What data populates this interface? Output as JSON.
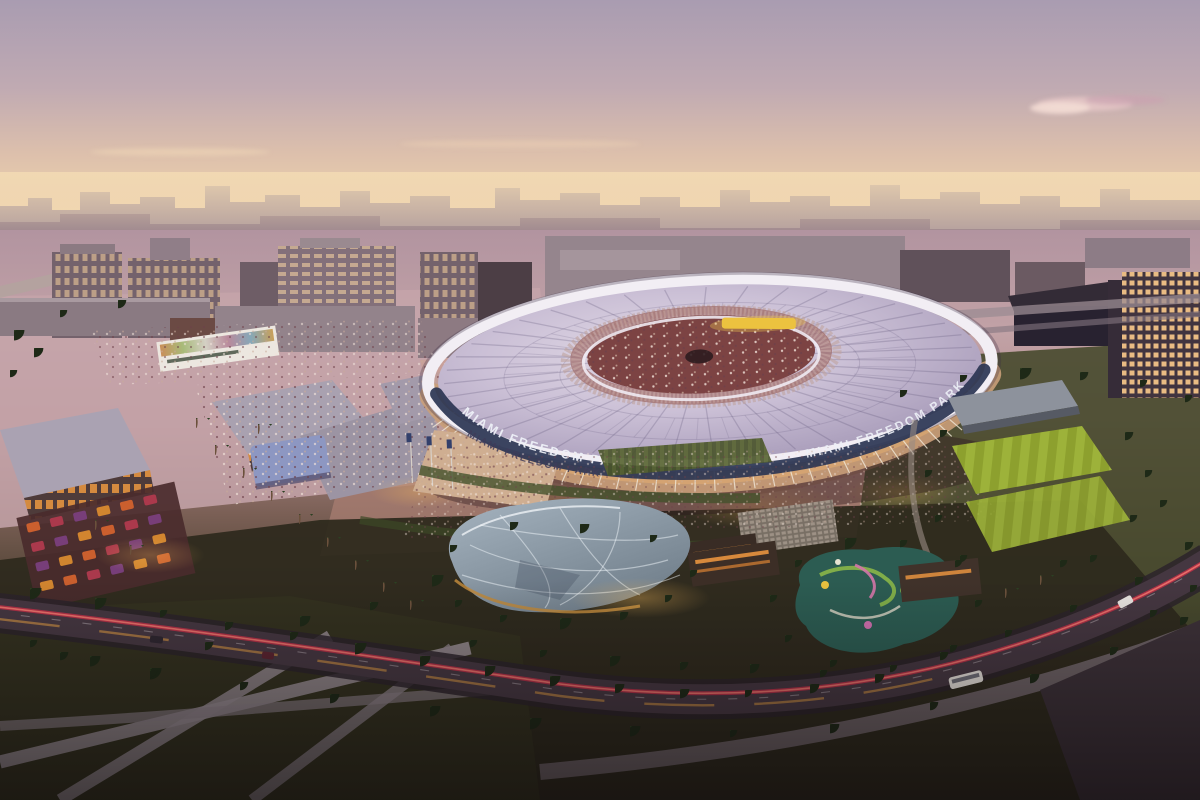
{
  "scene": {
    "stadium": {
      "rim_signage_left": "MIAMI FREEDOM PARK",
      "rim_signage_right": "MIAMI FREEDOM PARK",
      "facade_signage": "MIAMI FREEDOM PARK"
    },
    "palette": {
      "sky_top": "#a99cb1",
      "sky_mid": "#c0aab2",
      "sky_horizon": "#f3dcb6",
      "skyline_haze": "#9f8c96",
      "stadium_roof": "#cbc0d6",
      "stadium_ring": "#f2eef4",
      "signage_band": "#2b3552",
      "signage_text": "#eef1f8",
      "scoreboard_yellow": "#ecc23f",
      "crowd_bowl": "#7c4343",
      "retail_roof": "#a9a1b0",
      "plaza_pink": "#c5a5aa",
      "lawn_dark": "#33311f",
      "pitch_green": "#8da02e",
      "canopy_grey": "#93a2b0",
      "playground_teal": "#2c5c52",
      "road_asphalt": "#453741",
      "taillight_red": "#c92f49",
      "headlight_amber": "#dd9a42",
      "tree_green": "#25301c",
      "glow_amber": "#f8bc5c"
    }
  }
}
